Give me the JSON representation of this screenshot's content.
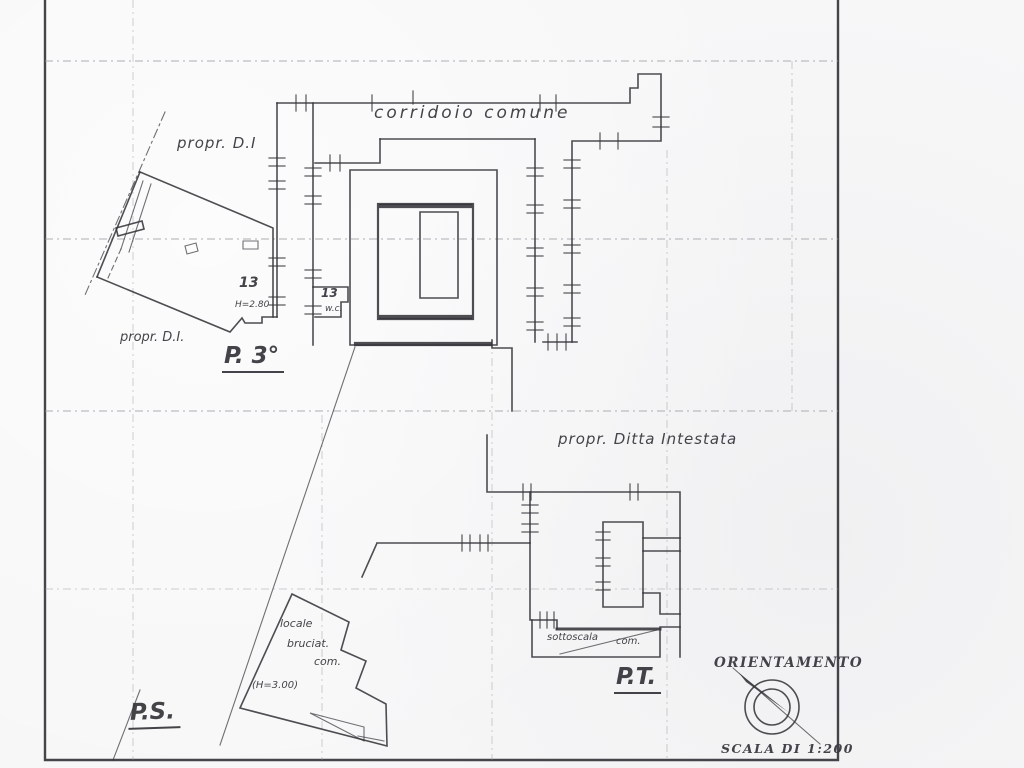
{
  "colors": {
    "ink": "#34343a",
    "faint": "#96969e",
    "paper": "#f7f7f8"
  },
  "plan_upper": {
    "title": "P. 3°",
    "corridor": "corridoio comune",
    "owner_top": "propr. D.I",
    "owner_bottom": "propr. D.I.",
    "room_number": "13",
    "room_height": "H=2.80",
    "wc_number": "13",
    "wc_label": "w.c."
  },
  "plan_ground": {
    "title": "P.T.",
    "owner": "propr. Ditta Intestata",
    "understairs": "sottoscala",
    "understairs_com": "com."
  },
  "plan_basement": {
    "title": "P.S.",
    "room_line1": "locale",
    "room_line2": "bruciat.",
    "room_line3": "com.",
    "room_height": "(H=3.00)"
  },
  "legend": {
    "orientation": "ORIENTAMENTO",
    "scale": "SCALA DI 1:200"
  }
}
